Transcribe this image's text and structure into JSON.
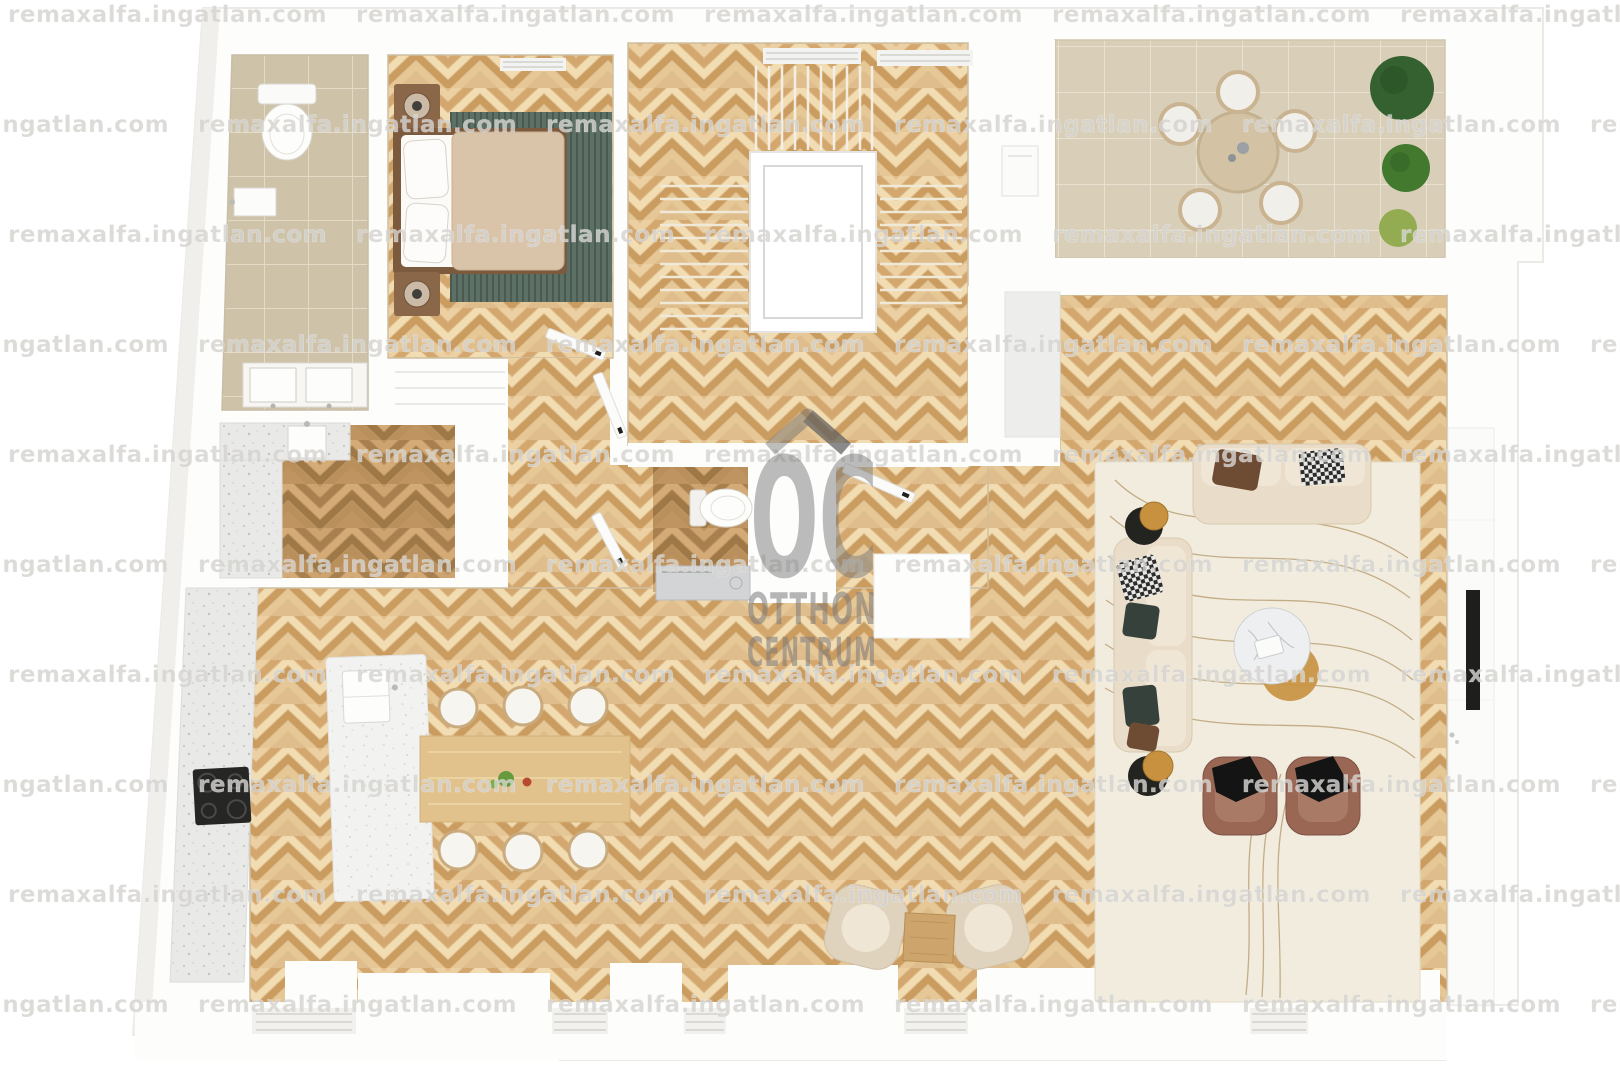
{
  "watermark": {
    "text": "remaxalfa.ingatlan.com"
  },
  "logo": {
    "initials": "OC",
    "line1": "OTTHON",
    "line2": "CENTRUM"
  },
  "colors": {
    "wall": "#fdfdfc",
    "wall_shade": "#f0efec",
    "parquet": "#dfbd8d",
    "parquet_dark": "#bf9461",
    "tile_bath": "#cec3a9",
    "tile_terrace": "#d9cfb8",
    "counter": "#e9e9e7",
    "island": "#f2f2f0",
    "rug_living": "#f2ecdf",
    "rug_bedroom": "#5d7066",
    "sofa": "#e9ddc9",
    "cushion": "#f0e6d6",
    "armchair": "#996753",
    "armchair_pale": "#e0d3bd",
    "plant_dark": "#35602f",
    "plant_mid": "#43792f",
    "plant_light": "#93ac52",
    "table_wood": "#e2c28c",
    "tv": "#1e1e1c",
    "gold": "#c8913f",
    "marble": "#edeff0",
    "duvet": "#d9c3a9",
    "bed_frame": "#7c5a3e",
    "nightstand": "#8a6748",
    "washer": "#d3d4d6",
    "cooktop": "#262624"
  }
}
